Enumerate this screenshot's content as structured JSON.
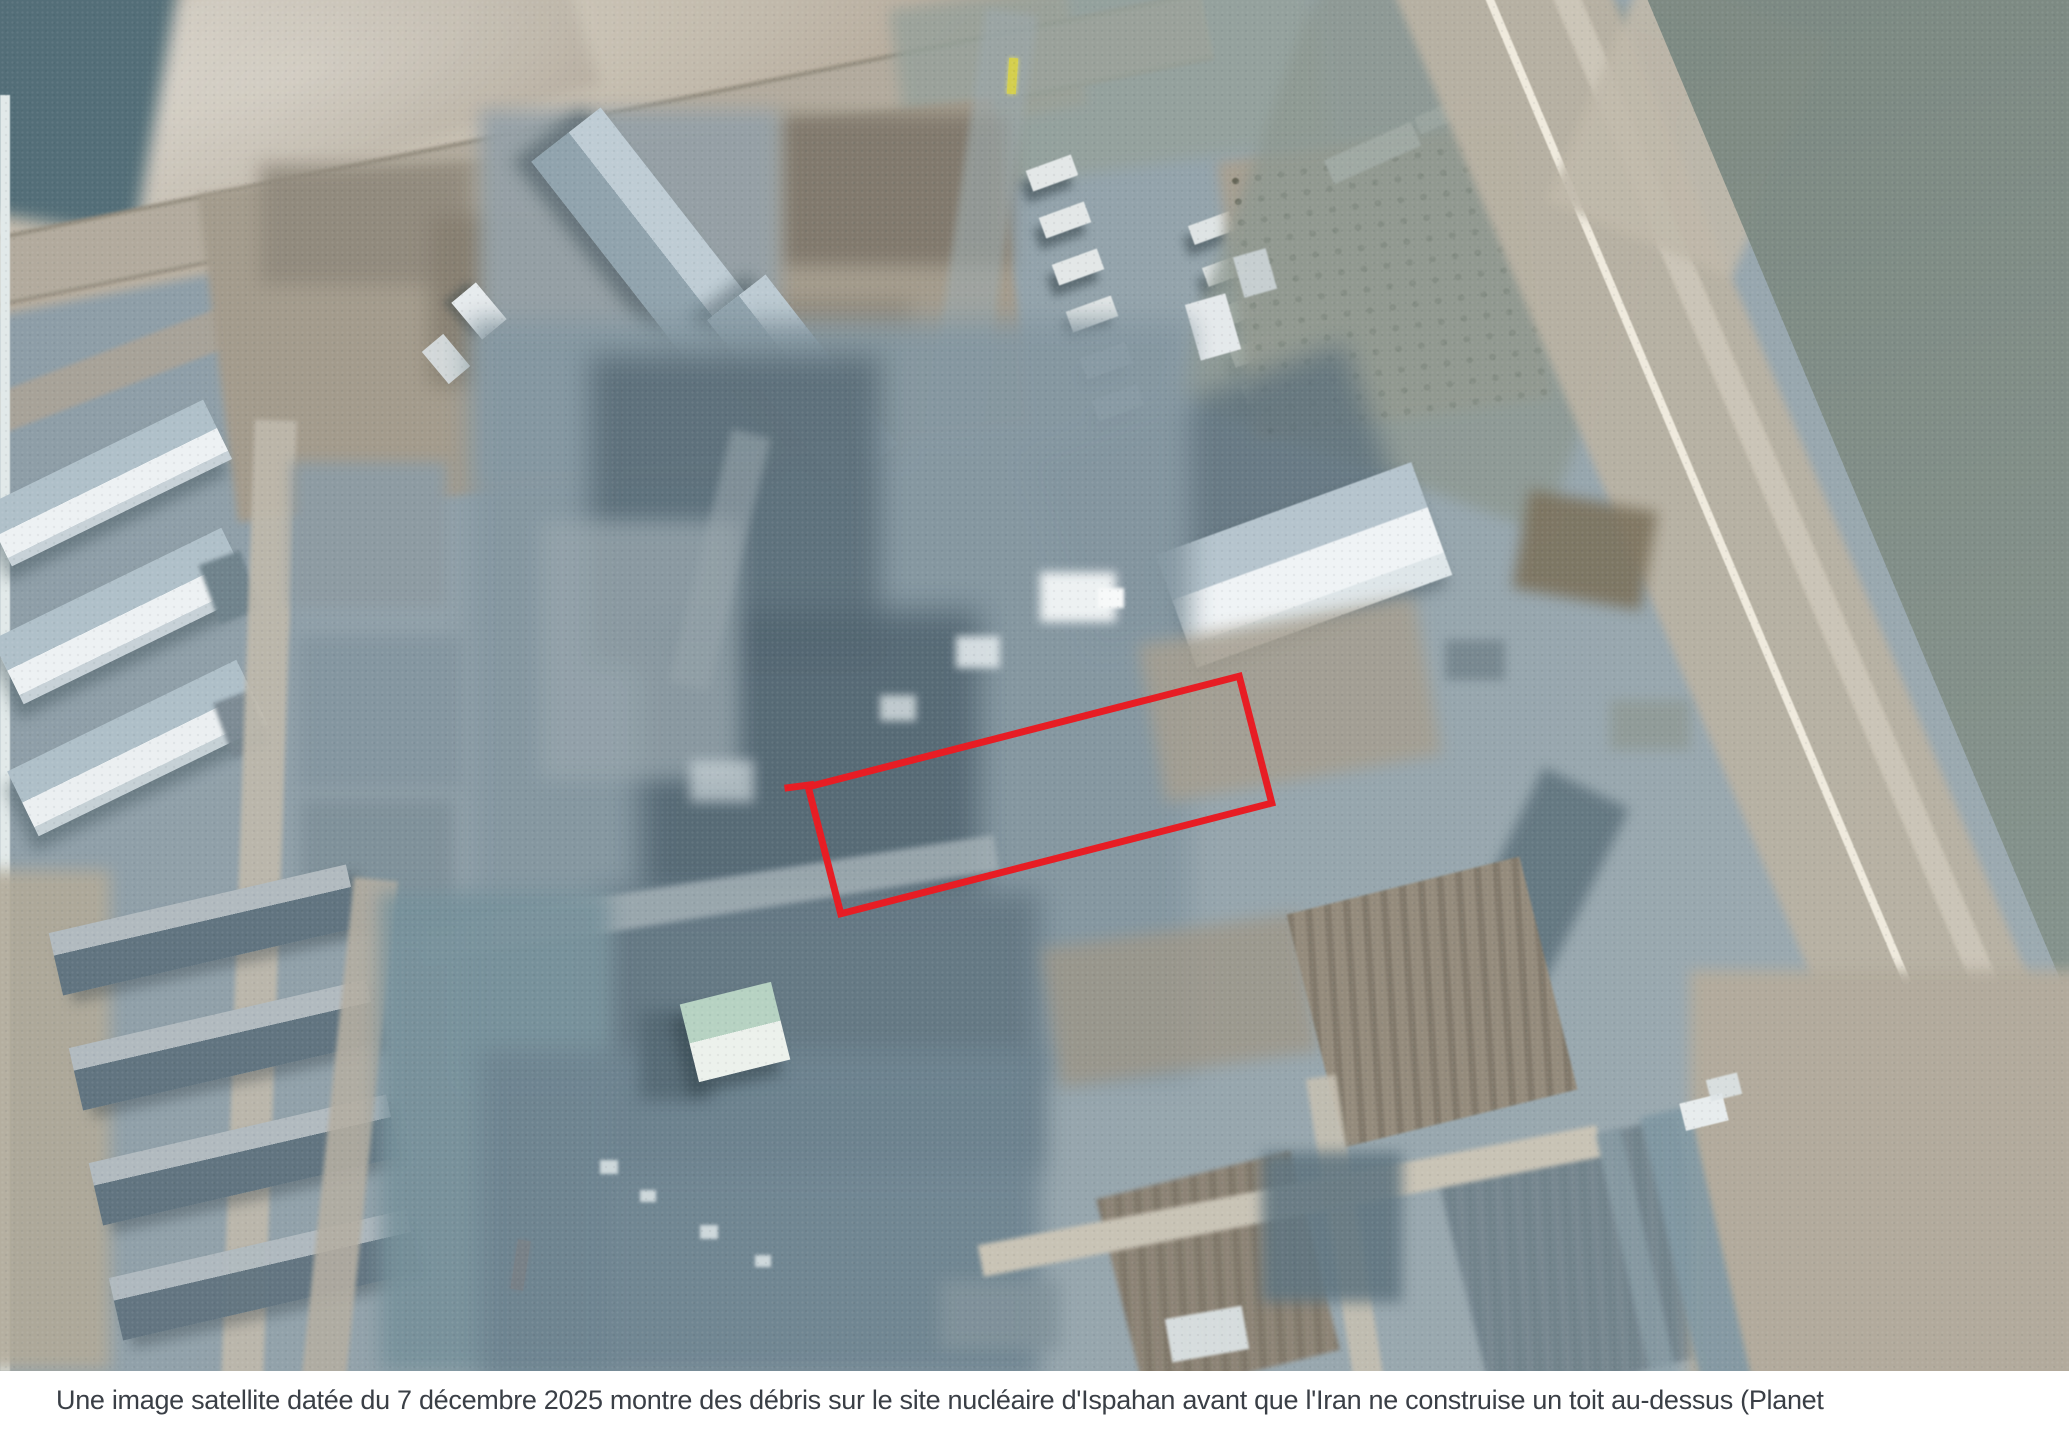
{
  "photo": {
    "kind": "satellite-photograph",
    "dominant_colors": [
      "#93a3ab",
      "#b2aa9b",
      "#5e7380",
      "#eef2f4"
    ]
  },
  "annotation": {
    "shape": "rectangle",
    "color": "#e71d24"
  },
  "caption": {
    "text": "Une image satellite datée du 7 décembre 2025 montre des débris sur le site nucléaire d'Ispahan avant que l'Iran ne construise un toit au-dessus (Planet",
    "text_color": "#3a3f46",
    "background": "#ffffff"
  }
}
